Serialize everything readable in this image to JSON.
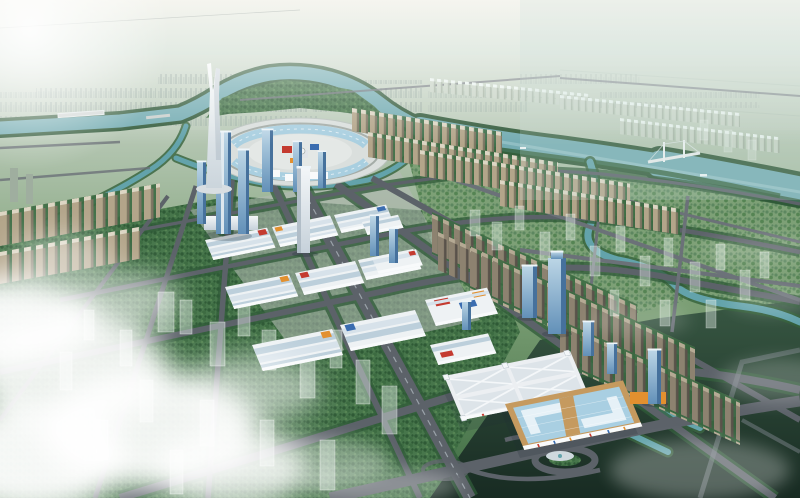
{
  "image_alt": "Aerial dusk rendering of a planned riverside city: a winding teal river, a twin-pronged white landmark spire beside a circular glass-canopy plaza, rows of warehouse market halls with red signs, blue glass office towers, tan residential slab rows, two large exhibition halls (one white-roofed, one blue-glass with tan trim), a tree-lined road grid over green blocks with translucent future buildings, clouds over the lower-left and dark misty fields at lower-right",
  "scene": {
    "landmark": "twin-spire-tower",
    "plaza": "circular-glass-canopy-plaza",
    "water": [
      "meandering-river",
      "canal-network",
      "roadside-water-strips"
    ],
    "districts": [
      "warehouse-market-district",
      "exhibition-center",
      "glass-office-towers",
      "residential-slab-rows",
      "planned-ghost-blocks",
      "distant-city"
    ],
    "infrastructure": [
      "diagonal-road-grid",
      "tree-lined-boulevard",
      "roundabout-interchange",
      "river-bridges"
    ],
    "atmosphere": [
      "cloud-bank-lower-left",
      "sun-glow-upper-left",
      "mist-lower-right",
      "hazy-horizon"
    ]
  },
  "palette": {
    "sky_top": "#f5f5ef",
    "sky_bottom": "#dde8e0",
    "horizon_haze": "#c9d6c7",
    "far_land": "#b7c8b5",
    "distant_city": "#9fb0a6",
    "distant_city_light": "#aebdb2",
    "river_water": "#74acb2",
    "river_bank": "#2e5737",
    "river_highlight": "#c2e0e1",
    "canal_water": "#63a3ab",
    "park_base": "#47764b",
    "park_dot_dark": "#2f5a36",
    "park_dot_mid": "#3c6b41",
    "park_dot_light": "#558453",
    "park_light_base": "#7da076",
    "park_light_dot": "#5d8760",
    "row_green": "#3a6a41",
    "road_main": "#5c6269",
    "road_minor": "#6b7178",
    "road_faint": "#7b838a",
    "road_centerline": "#9aa2a9",
    "tree_line": "#2f5a38",
    "paving": "#b4bab6",
    "warehouse_wall": "#eef2f4",
    "warehouse_roof_a": "#bccfdb",
    "warehouse_roof_b": "#d7e2ea",
    "warehouse_facade": "#f8fafb",
    "accent_red": "#c43b30",
    "accent_orange": "#e2902f",
    "accent_blue": "#3b6db0",
    "glass_top": "#bcd6e6",
    "glass_bottom": "#6290b8",
    "glass_side": "#46719c",
    "glass_cap": "#eef5f9",
    "tower_white_top": "#f3f6f8",
    "tower_white_bottom": "#c6d1da",
    "tower_white_side": "#a9b6c1",
    "spire_top": "#f7f9f9",
    "spire_bottom": "#cbd5dc",
    "plaza_ring": "#dadfdd",
    "plaza_inner": "#e4e8e6",
    "plaza_road": "#9aa39e",
    "canopy_glass": "#a9cfe0",
    "residential_tan": "#b3a58a",
    "residential_tan_side": "#7e7462",
    "residential_tan_roof": "#ddd6c4",
    "residential_brown": "#8d8270",
    "residential_brown_side": "#59524a",
    "residential_brown_roof": "#b5aa94",
    "residential_pale": "#c6d2c4",
    "residential_pale_side": "#9fae9d",
    "ghost": "#e9f3ee",
    "exhibition_wall": "#eceff2",
    "exhibition_panel": "#dde4e9",
    "exhibition_ridge": "#f4f7f9",
    "exhibition_tan": "#c59a5f",
    "exhibition_glass": "#a9cfe2",
    "exhibition_glass_panel": "#e6f1f7",
    "dark_top": "#33523f",
    "dark_bottom": "#152620",
    "cloud": "#ffffff",
    "shadow": "#1d2b33",
    "bridge_light": "#e3e9e9"
  }
}
